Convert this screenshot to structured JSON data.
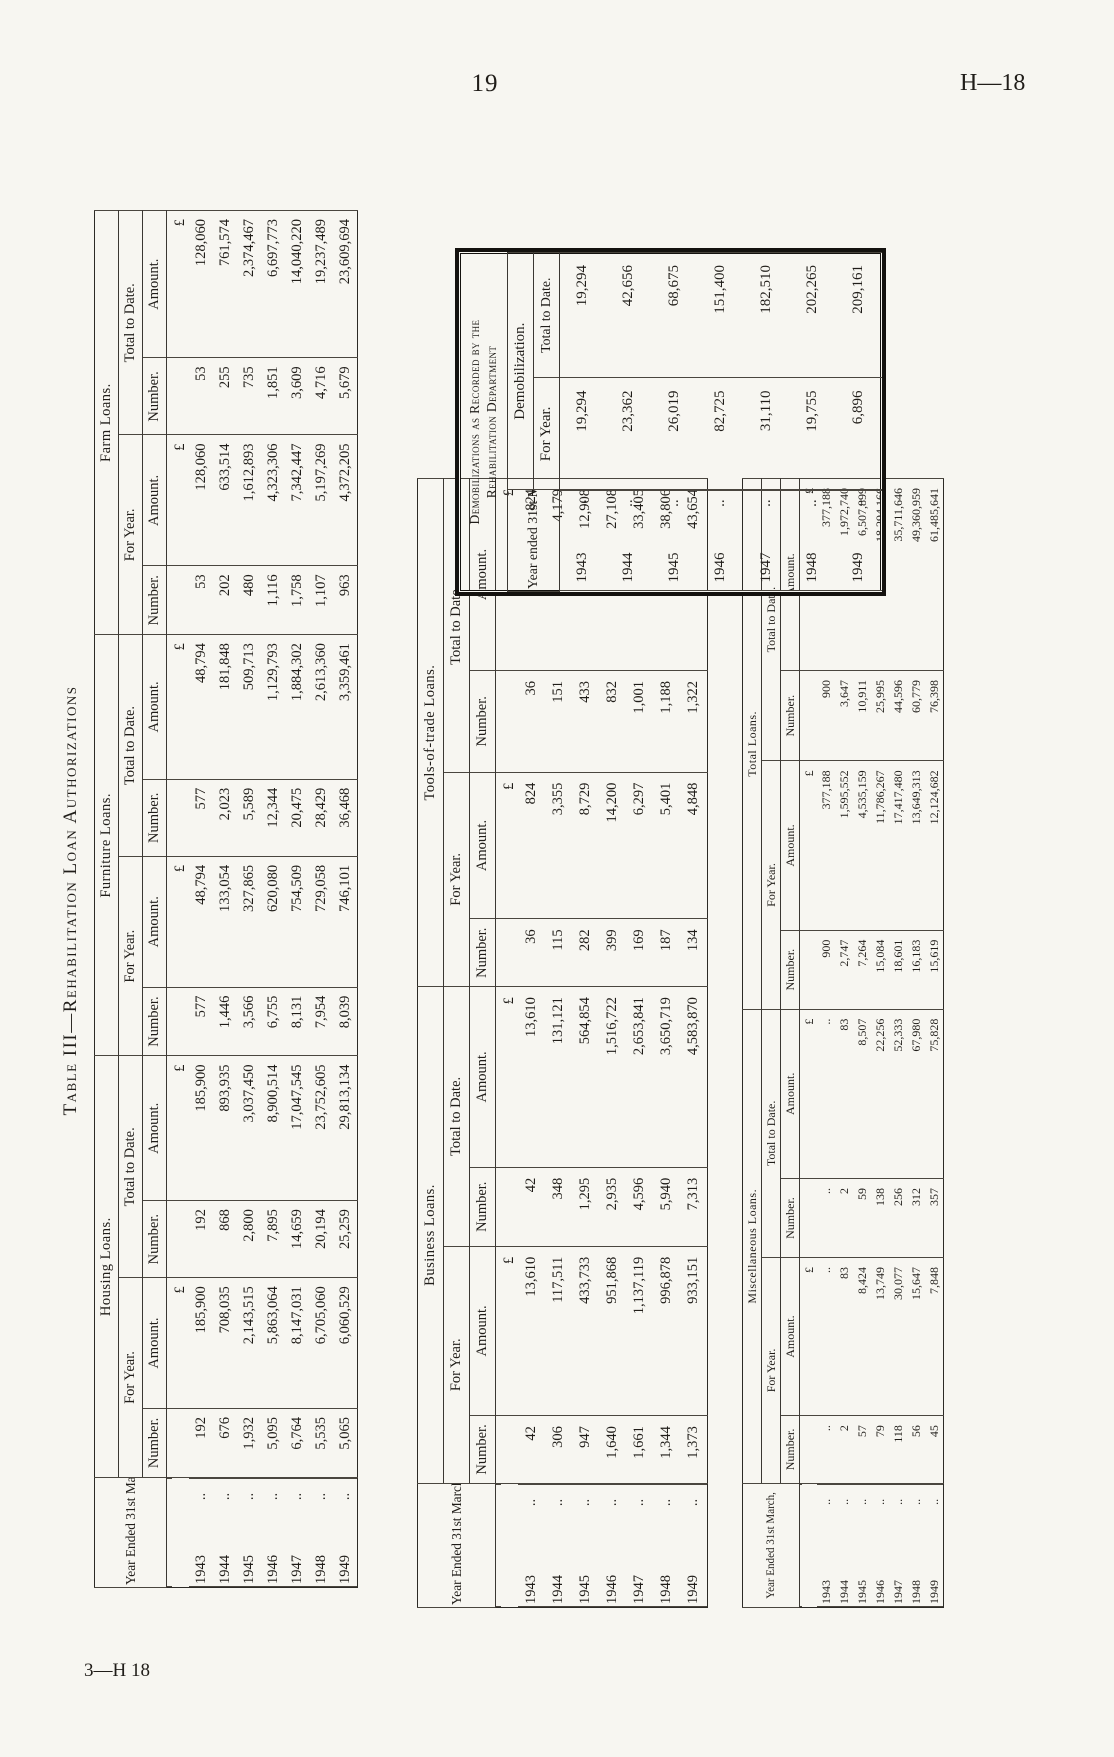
{
  "page": {
    "number": "19",
    "doc_ref": "H—18",
    "footer_sig": "3—H 18",
    "leader_dots": "..",
    "currency": "£"
  },
  "title": "Table III—Rehabilitation Loan Authorizations",
  "headers": {
    "year_col": "Year Ended 31st March,",
    "for_year": "For Year.",
    "total_to_date": "Total to Date.",
    "number": "Number.",
    "amount": "Amount."
  },
  "table1": {
    "sections": [
      "Housing Loans.",
      "Furniture Loans.",
      "Farm Loans."
    ],
    "rows": [
      [
        "",
        "",
        "£",
        "",
        "£",
        "",
        "£",
        "",
        "£",
        "",
        "£",
        "",
        "£"
      ],
      [
        "1943",
        "192",
        "185,900",
        "192",
        "185,900",
        "577",
        "48,794",
        "577",
        "48,794",
        "53",
        "128,060",
        "53",
        "128,060"
      ],
      [
        "1944",
        "676",
        "708,035",
        "868",
        "893,935",
        "1,446",
        "133,054",
        "2,023",
        "181,848",
        "202",
        "633,514",
        "255",
        "761,574"
      ],
      [
        "1945",
        "1,932",
        "2,143,515",
        "2,800",
        "3,037,450",
        "3,566",
        "327,865",
        "5,589",
        "509,713",
        "480",
        "1,612,893",
        "735",
        "2,374,467"
      ],
      [
        "1946",
        "5,095",
        "5,863,064",
        "7,895",
        "8,900,514",
        "6,755",
        "620,080",
        "12,344",
        "1,129,793",
        "1,116",
        "4,323,306",
        "1,851",
        "6,697,773"
      ],
      [
        "1947",
        "6,764",
        "8,147,031",
        "14,659",
        "17,047,545",
        "8,131",
        "754,509",
        "20,475",
        "1,884,302",
        "1,758",
        "7,342,447",
        "3,609",
        "14,040,220"
      ],
      [
        "1948",
        "5,535",
        "6,705,060",
        "20,194",
        "23,752,605",
        "7,954",
        "729,058",
        "28,429",
        "2,613,360",
        "1,107",
        "5,197,269",
        "4,716",
        "19,237,489"
      ],
      [
        "1949",
        "5,065",
        "6,060,529",
        "25,259",
        "29,813,134",
        "8,039",
        "746,101",
        "36,468",
        "3,359,461",
        "963",
        "4,372,205",
        "5,679",
        "23,609,694"
      ]
    ]
  },
  "table2": {
    "sections": [
      "Business Loans.",
      "Tools-of-trade Loans."
    ],
    "rows": [
      [
        "",
        "",
        "£",
        "",
        "£",
        "",
        "£",
        "",
        "£"
      ],
      [
        "1943",
        "42",
        "13,610",
        "42",
        "13,610",
        "36",
        "824",
        "36",
        "824"
      ],
      [
        "1944",
        "306",
        "117,511",
        "348",
        "131,121",
        "115",
        "3,355",
        "151",
        "4,179"
      ],
      [
        "1945",
        "947",
        "433,733",
        "1,295",
        "564,854",
        "282",
        "8,729",
        "433",
        "12,908"
      ],
      [
        "1946",
        "1,640",
        "951,868",
        "2,935",
        "1,516,722",
        "399",
        "14,200",
        "832",
        "27,108"
      ],
      [
        "1947",
        "1,661",
        "1,137,119",
        "4,596",
        "2,653,841",
        "169",
        "6,297",
        "1,001",
        "33,405"
      ],
      [
        "1948",
        "1,344",
        "996,878",
        "5,940",
        "3,650,719",
        "187",
        "5,401",
        "1,188",
        "38,806"
      ],
      [
        "1949",
        "1,373",
        "933,151",
        "7,313",
        "4,583,870",
        "134",
        "4,848",
        "1,322",
        "43,654"
      ]
    ]
  },
  "table3": {
    "sections": [
      "Miscellaneous Loans.",
      "Total Loans."
    ],
    "rows": [
      [
        "",
        "",
        "£",
        "",
        "£",
        "",
        "£",
        "",
        "£"
      ],
      [
        "1943",
        "..",
        "..",
        "..",
        "..",
        "900",
        "377,188",
        "900",
        "377,188"
      ],
      [
        "1944",
        "2",
        "83",
        "2",
        "83",
        "2,747",
        "1,595,552",
        "3,647",
        "1,972,740"
      ],
      [
        "1945",
        "57",
        "8,424",
        "59",
        "8,507",
        "7,264",
        "4,535,159",
        "10,911",
        "6,507,899"
      ],
      [
        "1946",
        "79",
        "13,749",
        "138",
        "22,256",
        "15,084",
        "11,786,267",
        "25,995",
        "18,294,166"
      ],
      [
        "1947",
        "118",
        "30,077",
        "256",
        "52,333",
        "18,601",
        "17,417,480",
        "44,596",
        "35,711,646"
      ],
      [
        "1948",
        "56",
        "15,647",
        "312",
        "67,980",
        "16,183",
        "13,649,313",
        "60,779",
        "49,360,959"
      ],
      [
        "1949",
        "45",
        "7,848",
        "357",
        "75,828",
        "15,619",
        "12,124,682",
        "76,398",
        "61,485,641"
      ]
    ]
  },
  "demob": {
    "title_line1": "Demobilizations as Recorded by the",
    "title_line2": "Rehabilitation Department",
    "year_col": "Year ended 31st March,",
    "group": "Demobilization.",
    "rows": [
      [
        "1943",
        "19,294",
        "19,294"
      ],
      [
        "1944",
        "23,362",
        "42,656"
      ],
      [
        "1945",
        "26,019",
        "68,675"
      ],
      [
        "1946",
        "82,725",
        "151,400"
      ],
      [
        "1947",
        "31,110",
        "182,510"
      ],
      [
        "1948",
        "19,755",
        "202,265"
      ],
      [
        "1949",
        "6,896",
        "209,161"
      ]
    ]
  }
}
